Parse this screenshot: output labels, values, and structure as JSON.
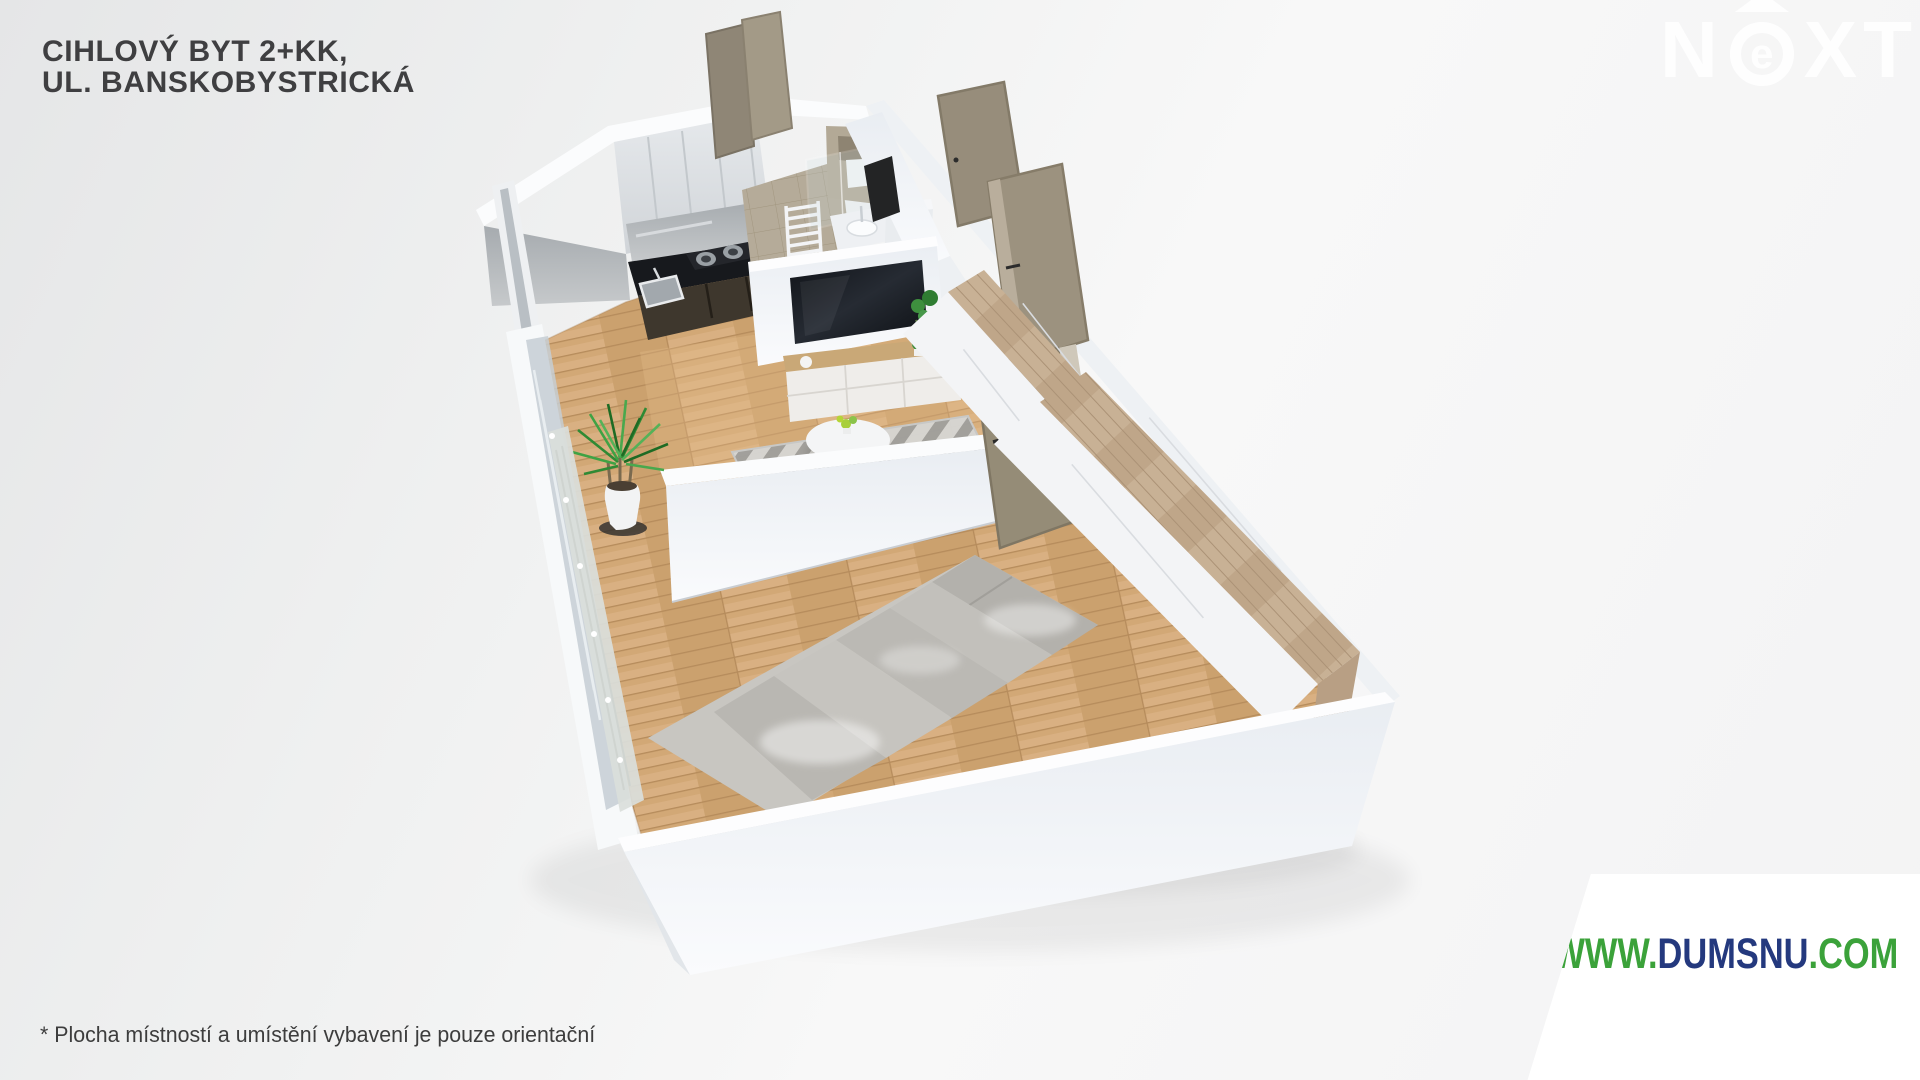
{
  "title": {
    "line1": "CIHLOVÝ BYT 2+KK,",
    "line2": "UL. BANSKOBYSTRICKÁ"
  },
  "logo": {
    "name": "NEXT",
    "part_n": "N",
    "part_e": "e",
    "part_xt": "XT",
    "arrow_icon": "triangle-up",
    "color": "#ffffff"
  },
  "watermark": {
    "www": "WWW.",
    "domain": "DUMSNU",
    "tld": ".COM",
    "green": "#3ba23a",
    "navy": "#24397e",
    "plate_color": "#ffffff"
  },
  "disclaimer": "* Plocha místností a umístění vybavení je pouze orientační",
  "palette": {
    "background": "#eff0f0",
    "wall_white": "#f1f3f6",
    "wall_top": "#fbfcfd",
    "wood_floor": "#d2a876",
    "wood_wardrobe": "#c9b194",
    "door_taupe": "#9a9180",
    "kitchen_counter": "#17191d",
    "bathroom_tile": "#b6ac9a",
    "bed_linen": "#c8c6c1",
    "plant_green": "#3fa244",
    "title_text": "#3f3f41",
    "disclaimer_text": "#3d3d3d"
  },
  "scene": {
    "type": "3d-floor-plan-render",
    "rooms_depicted": [
      "kitchen",
      "bathroom",
      "living-area",
      "hallway",
      "bedroom"
    ]
  }
}
